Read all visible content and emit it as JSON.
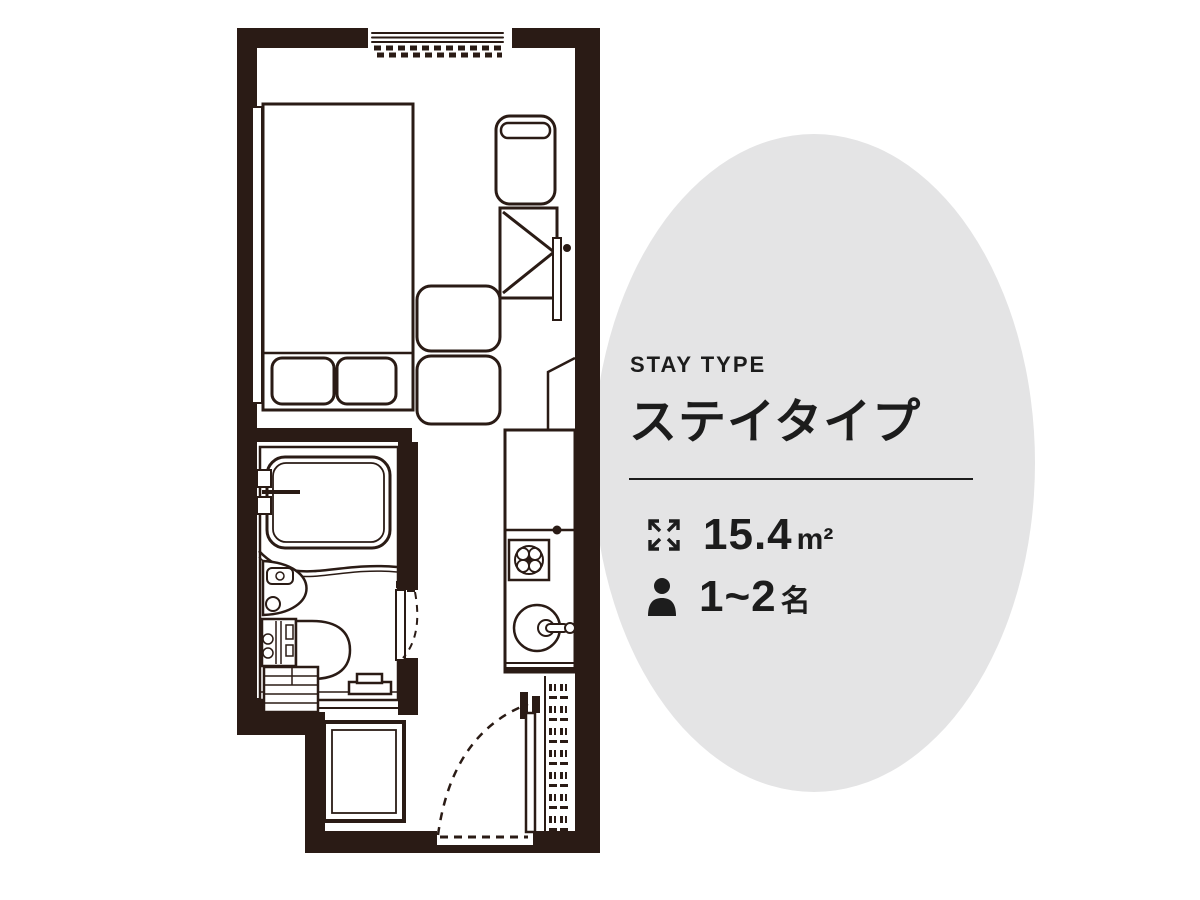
{
  "colors": {
    "page_bg": "#ffffff",
    "circle_bg": "#e4e4e5",
    "wall": "#2a1b15",
    "line": "#2a1b15",
    "text": "#1c1c1c"
  },
  "info_panel": {
    "label_en": "STAY TYPE",
    "title_ja": "ステイタイプ",
    "area": {
      "value": "15.4",
      "unit": "m²"
    },
    "capacity": {
      "value": "1~2",
      "unit": "名"
    }
  }
}
